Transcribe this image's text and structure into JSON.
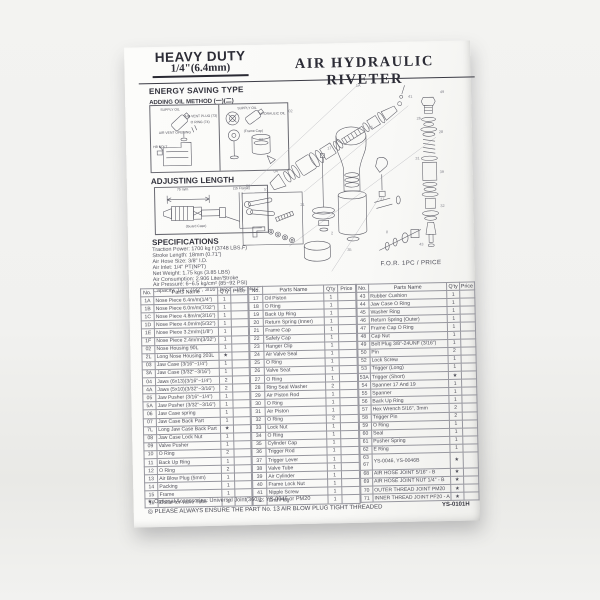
{
  "page": {
    "brand": {
      "line1": "HEAVY DUTY",
      "line2": "1/4\"(6.4mm)"
    },
    "title": "AIR HYDRAULIC RIVETER",
    "energy": {
      "heading": "ENERGY SAVING TYPE",
      "subheading": "ADDING OIL METHOD (一)(二)",
      "panel1_labels": [
        "SUPPLY OIL",
        "AIR VENT PLUG (73)",
        "O RING (74)",
        "AIR VENT OPENING",
        "HB BOLT"
      ],
      "panel2_labels": [
        "SUPPLY OIL",
        "HYDRAULIC OIL",
        "(Frame Cap)"
      ]
    },
    "adjust": {
      "heading": "ADJUSTING LENGTH",
      "labels": [
        "75 m/m",
        "(15 Frame)",
        "(Guard Case)"
      ]
    },
    "specs": {
      "heading": "SPECIFICATIONS",
      "lines": [
        "Traction Power: 1700 kg f (3748 LBS.F)",
        "Stroke Length: 18mm (0.71\")",
        "Air Hose Size: 3/8\" I.D.",
        "Air Inlet: 1/4\" PT(NPT)",
        "Net Weight: 1.75 kgs (3.85 LBS)",
        "Air Consumption: 2.906 Liter/Stroke",
        "Air Pressure: 6~6.5 kg/cm² (85~92 PSI)",
        "Capacity: 1/4\", 7/32\", 3/16\", 5/32\", 1/8\", 3/32\""
      ]
    },
    "diagram": {
      "price_note": "F.O.R. 1PC / PRICE",
      "callouts": [
        "1A",
        "02",
        "03",
        "04",
        "06",
        "15",
        "17",
        "20",
        "21",
        "26",
        "28",
        "31",
        "32",
        "35",
        "37",
        "39",
        "41",
        "43",
        "49",
        "57"
      ]
    },
    "table": {
      "headers": [
        "No.",
        "Parts Name",
        "Q'ty",
        "Price"
      ],
      "groups": [
        {
          "rows": [
            [
              "1A",
              "Nose Piece 6.4m/m(1/4\")",
              "1"
            ],
            [
              "1B",
              "Nose Piece 6.0m/m(7/32\")",
              "1"
            ],
            [
              "1C",
              "Nose Piece 4.8m/m(3/16\")",
              "1"
            ],
            [
              "1D",
              "Nose Piece 4.0m/m(5/32\")",
              "1"
            ],
            [
              "1E",
              "Nose Piece 3.2m/m(1/8\")",
              "1"
            ],
            [
              "1F",
              "Nose Piece 2.4m/m(3/32\")",
              "1"
            ],
            [
              "02",
              "Nose Housing 90L",
              "1"
            ],
            [
              "2L",
              "Long Nose Housing 203L",
              "★"
            ],
            [
              "03",
              "Jaw Case (3/16\"~1/4\")",
              "1"
            ],
            [
              "3A",
              "Jaw Case (3/32\"~3/16\")",
              "1"
            ],
            [
              "04",
              "Jaws (6x13)(3/16\"~1/4\")",
              "2"
            ],
            [
              "4A",
              "Jaws (5x10)(3/32\"~3/16\")",
              "2"
            ],
            [
              "05",
              "Jaw Pusher (3/16\"~1/4\")",
              "1"
            ],
            [
              "5A",
              "Jaw Pusher (3/32\"~3/16\")",
              "1"
            ],
            [
              "06",
              "Jaw Case spring",
              "1"
            ],
            [
              "07",
              "Jaw Case Back Part",
              "1"
            ],
            [
              "7L",
              "Long Jaw Case Back Part",
              "★"
            ],
            [
              "08",
              "Jaw Case Lock Nut",
              "1"
            ],
            [
              "09",
              "Valve Pusher",
              "1"
            ],
            [
              "10",
              "O Ring",
              "2"
            ],
            [
              "11",
              "Back Up Ring",
              "1"
            ],
            [
              "12",
              "O Ring",
              "2"
            ],
            [
              "13",
              "Air Blow Plug (5mm)",
              "1"
            ],
            [
              "14",
              "Packing",
              "1"
            ],
            [
              "15",
              "Frame",
              "1"
            ],
            [
              "16",
              "Collar for Valve Tube",
              "1"
            ]
          ]
        },
        {
          "rows": [
            [
              "17",
              "Oil Piston",
              "1"
            ],
            [
              "18",
              "O Ring",
              "1"
            ],
            [
              "19",
              "Back Up Ring",
              "1"
            ],
            [
              "20",
              "Return Spring (Inner)",
              "1"
            ],
            [
              "21",
              "Frame Cap",
              "1"
            ],
            [
              "22",
              "Safety Cap",
              "1"
            ],
            [
              "23",
              "Hanger Clip",
              "1"
            ],
            [
              "24",
              "Air Valve Seal",
              "1"
            ],
            [
              "25",
              "O Ring",
              "1"
            ],
            [
              "26",
              "Valve Seat",
              "1"
            ],
            [
              "27",
              "O Ring",
              "1"
            ],
            [
              "28",
              "Ring Seal Washer",
              "2"
            ],
            [
              "29",
              "Air Piston Rod",
              "1"
            ],
            [
              "30",
              "O Ring",
              "1"
            ],
            [
              "31",
              "Air Piston",
              "1"
            ],
            [
              "32",
              "O Ring",
              "2"
            ],
            [
              "33",
              "Lock Nut",
              "1"
            ],
            [
              "34",
              "O Ring",
              "1"
            ],
            [
              "35",
              "Cylinder Cap",
              "1"
            ],
            [
              "36",
              "Trigger Rod",
              "1"
            ],
            [
              "37",
              "Trigger Lever",
              "1"
            ],
            [
              "38",
              "Valve Tube",
              "1"
            ],
            [
              "39",
              "Air Cylinder",
              "1"
            ],
            [
              "40",
              "Frame Lock Nut",
              "1"
            ],
            [
              "41",
              "Nipple Screw",
              "1"
            ],
            [
              "42",
              "End Plug",
              "1"
            ]
          ]
        },
        {
          "rows": [
            [
              "43",
              "Rubber Cushion",
              "1"
            ],
            [
              "44",
              "Jaw Case O Ring",
              "1"
            ],
            [
              "45",
              "Washer Ring",
              "1"
            ],
            [
              "46",
              "Return Spring (Outer)",
              "1"
            ],
            [
              "47",
              "Frame Cap O Ring",
              "1"
            ],
            [
              "48",
              "Cap Nut",
              "1"
            ],
            [
              "49",
              "Bolt Plug 3/8\"-24UNF (3/16\")",
              "1"
            ],
            [
              "50",
              "Pin",
              "2"
            ],
            [
              "52",
              "Lock Screw",
              "1"
            ],
            [
              "53",
              "Trigger (Long)",
              "1"
            ],
            [
              "53A",
              "Trigger (Short)",
              "★"
            ],
            [
              "54",
              "Spanner 17 And 19",
              "1"
            ],
            [
              "55",
              "Spanner",
              "1"
            ],
            [
              "56",
              "Back Up Ring",
              "1"
            ],
            [
              "57",
              "Hex Wrench 5/16\", 3mm",
              "2"
            ],
            [
              "58",
              "Trigger Pin",
              "2"
            ],
            [
              "59",
              "O Ring",
              "1"
            ],
            [
              "60",
              "Seal",
              "1"
            ],
            [
              "61",
              "Pusher Spring",
              "1"
            ],
            [
              "62",
              "E Ring",
              "1"
            ],
            [
              "63|67",
              "YS-0046, YS-0046B",
              "★",
              2
            ],
            [
              "68",
              "AIR HOSE JOINT 5/16\" - B",
              "★"
            ],
            [
              "69",
              "AIR HOSE JOINT NUT 1/4\" - B",
              "★"
            ],
            [
              "70",
              "OUTER THREAD JOINT PM20",
              "★"
            ],
            [
              "71",
              "INNER THREAD JOINT PF20 - A",
              "★"
            ]
          ]
        }
      ]
    },
    "footer": {
      "note1": "★ Optional Accessories: Universal Joint(360°) ; YS-0046 or PM20",
      "note2": "◎ PLEASE ALWAYS ENSURE THE PART No. 13 AIR BLOW PLUG TIGHT THREADED",
      "code": "YS-0101H"
    }
  }
}
